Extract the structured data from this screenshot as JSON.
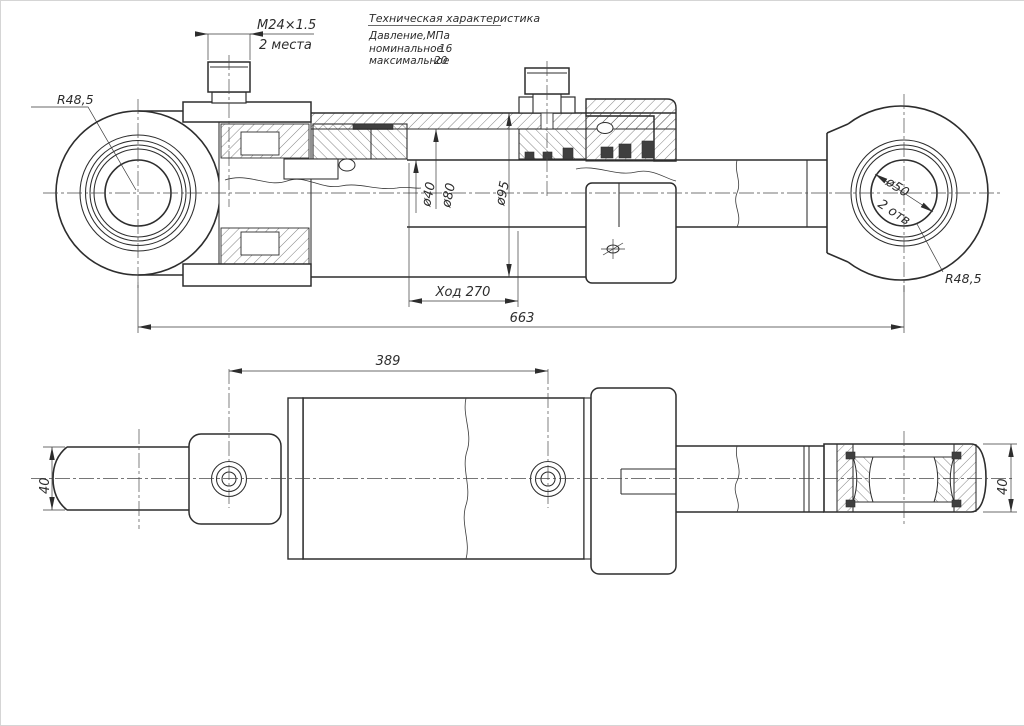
{
  "sheet": {
    "background": "#ffffff",
    "line_color": "#2d2d2d",
    "description": "Hydraulic cylinder two-view engineering drawing"
  },
  "notes": {
    "title": "Техническая характеристика",
    "pressure_label": "Давление,МПа",
    "nominal_label": "номинальное",
    "nominal_value": "16",
    "max_label": "максимальное",
    "max_value": "20"
  },
  "dimensions": {
    "thread_callout": "M24×1.5",
    "thread_places": "2 места",
    "left_eye_radius": "R48,5",
    "right_eye_radius": "R48,5",
    "rod_diameter": "ø40",
    "bore_diameter": "ø80",
    "tube_diameter": "ø95",
    "stroke_label": "Ход 270",
    "overall_length": "663",
    "eye_bore_diameter": "ø50",
    "eye_bore_count": "2 отв",
    "port_spacing": "389",
    "left_eye_width": "40",
    "right_eye_width": "40"
  }
}
